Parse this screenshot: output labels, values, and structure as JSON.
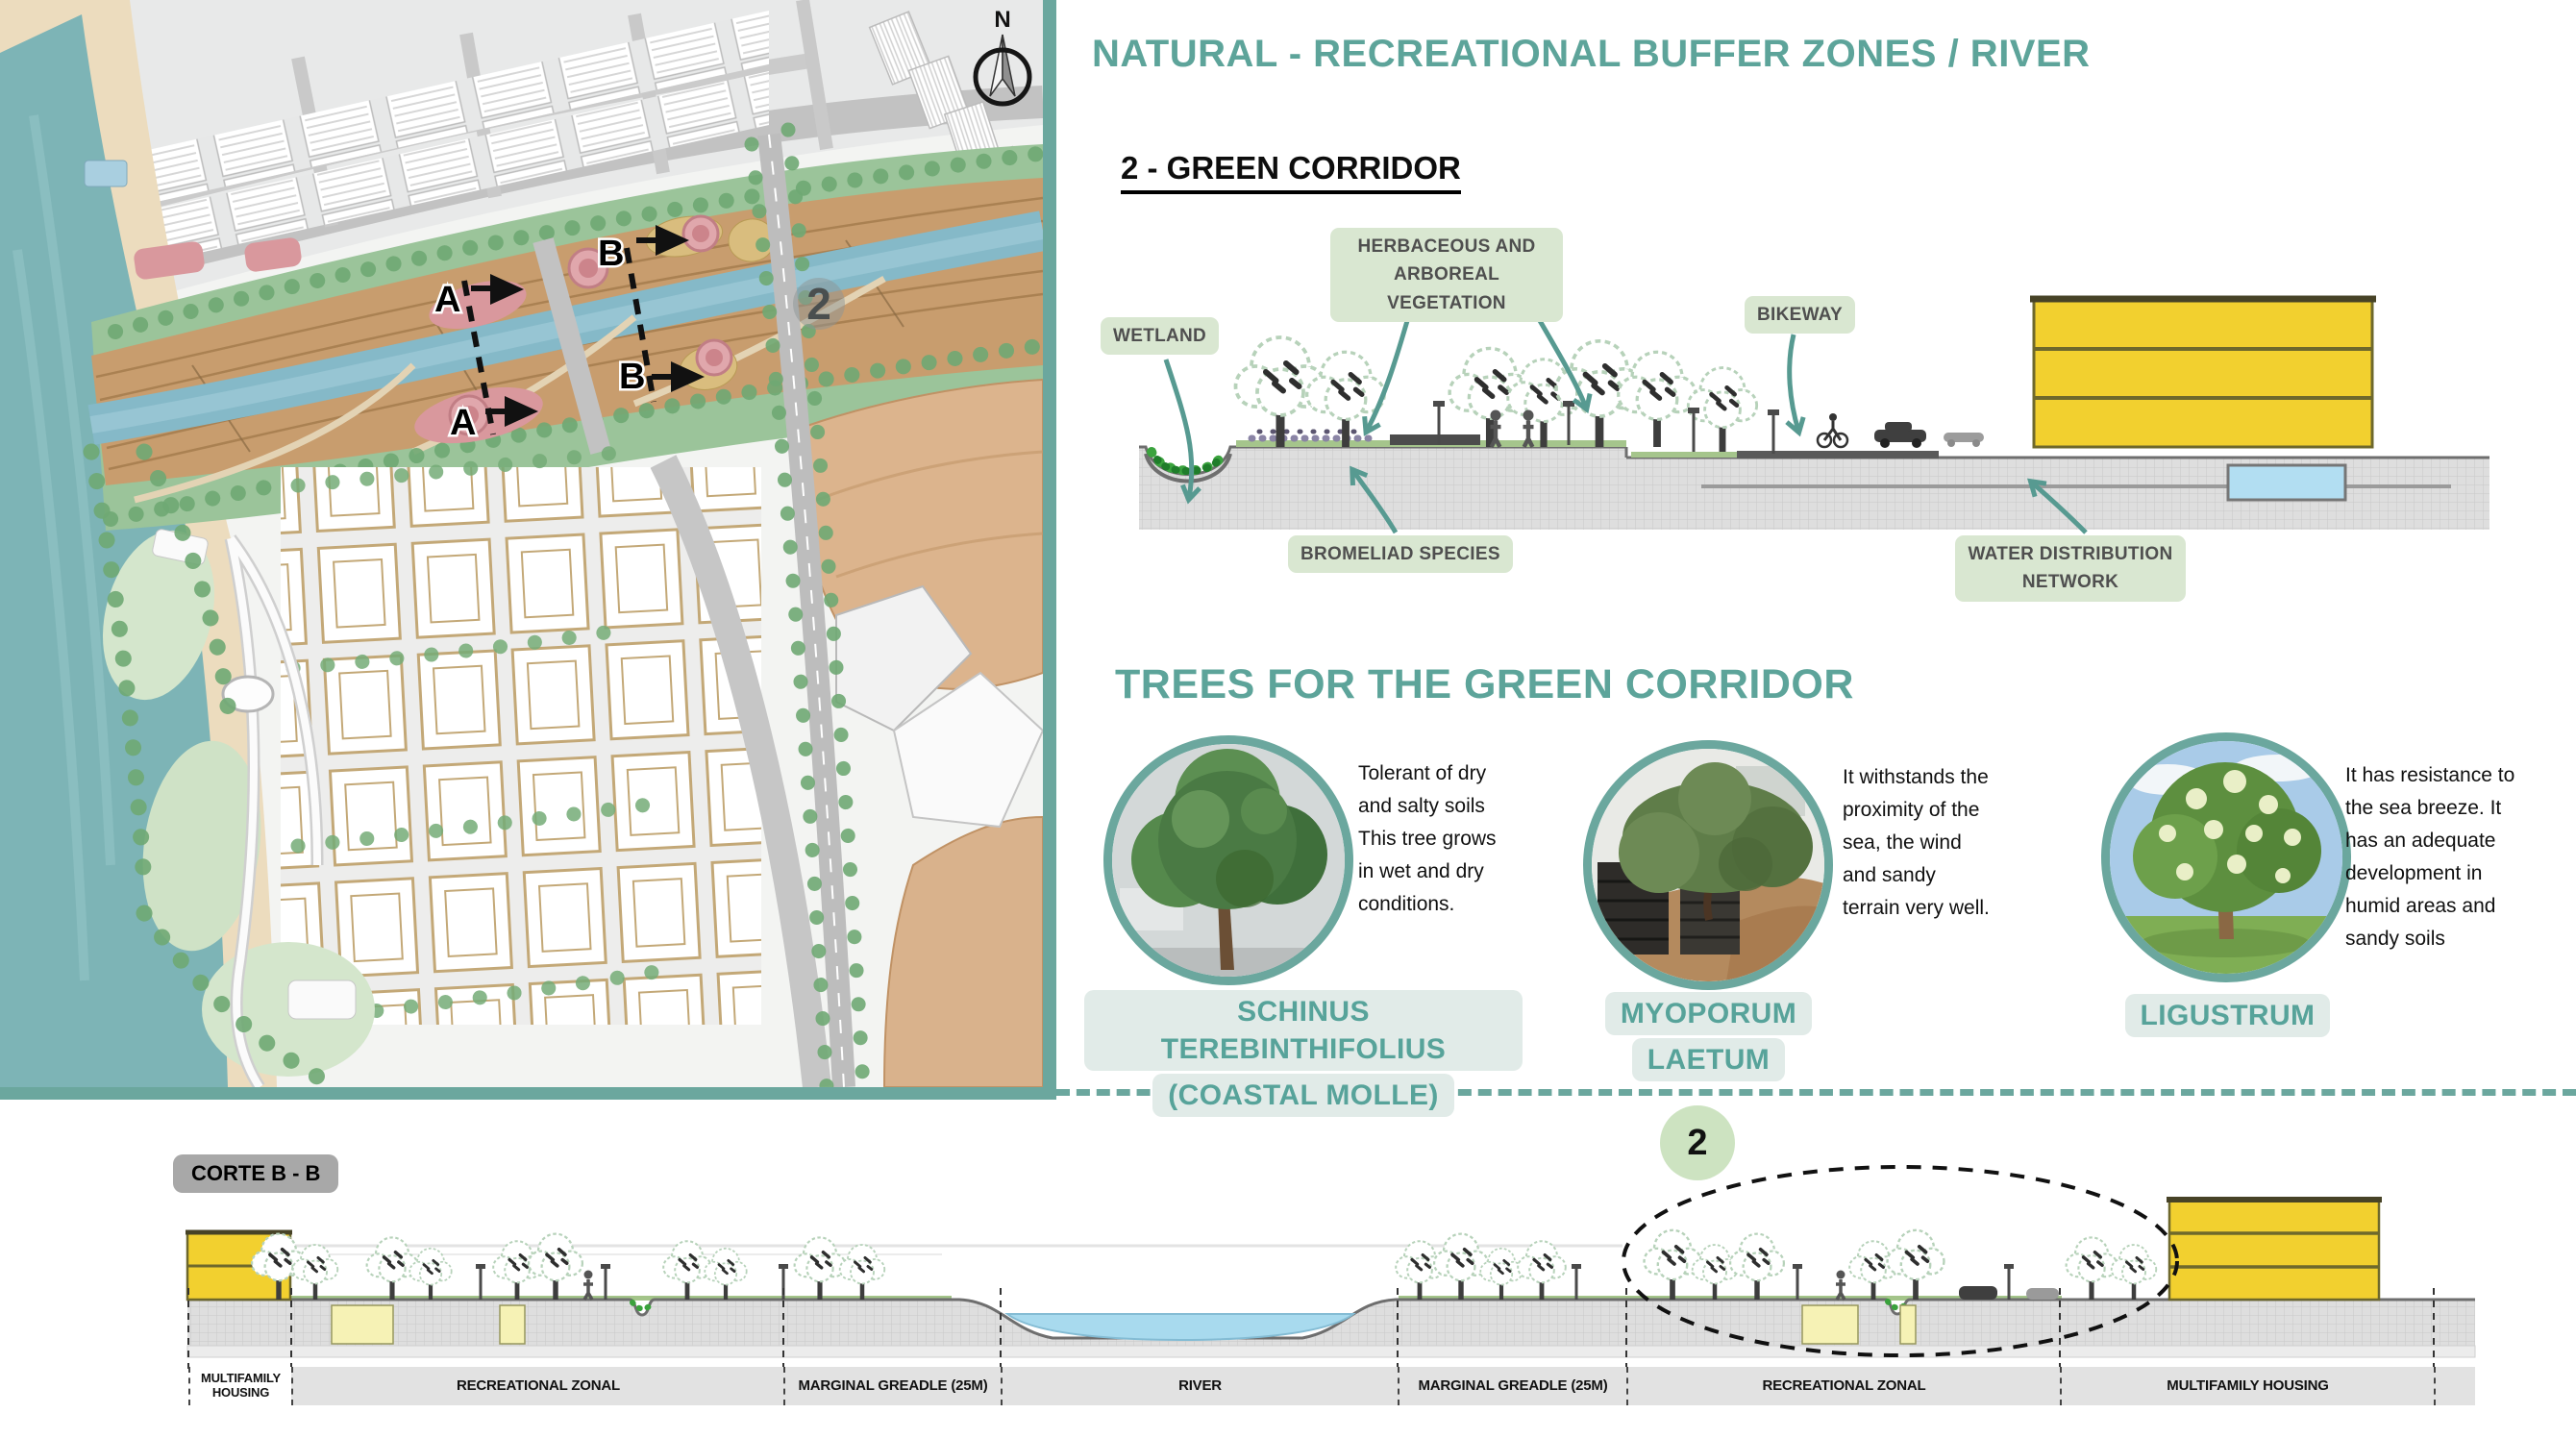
{
  "header": {
    "title": "NATURAL - RECREATIONAL BUFFER ZONES / RIVER"
  },
  "green_corridor": {
    "heading": "2 - GREEN CORRIDOR",
    "labels": {
      "wetland": "WETLAND",
      "herbaceous_line1": "HERBACEOUS AND",
      "herbaceous_line2": "ARBOREAL VEGETATION",
      "bikeway": "BIKEWAY",
      "bromeliad": "BROMELIAD SPECIES",
      "water_line1": "WATER DISTRIBUTION",
      "water_line2": "NETWORK"
    }
  },
  "trees": {
    "heading": "TREES FOR THE GREEN CORRIDOR",
    "items": [
      {
        "name_line1": "SCHINUS TEREBINTHIFOLIUS",
        "name_line2": "(COASTAL MOLLE)",
        "description": "Tolerant of dry and salty soils This tree grows in wet and dry conditions."
      },
      {
        "name_line1": "MYOPORUM",
        "name_line2": "LAETUM",
        "description": "It withstands the proximity of the sea, the wind and sandy terrain very well."
      },
      {
        "name_line1": "LIGUSTRUM",
        "name_line2": "",
        "description": "It has resistance to the sea breeze. It has an adequate development in humid areas and sandy soils"
      }
    ]
  },
  "map": {
    "compass_label": "N",
    "corridor_number": "2",
    "section_a_label": "A",
    "section_b_label": "B"
  },
  "corte": {
    "title": "CORTE B - B",
    "badge": "2",
    "zones": [
      "MULTIFAMILY HOUSING",
      "RECREATIONAL ZONAL",
      "MARGINAL GREADLE (25M)",
      "RIVER",
      "MARGINAL GREADLE (25M)",
      "RECREATIONAL ZONAL",
      "MULTIFAMILY HOUSING"
    ]
  },
  "colors": {
    "accent_teal": "#6ba79e",
    "title_teal": "#5da49a",
    "label_green_bg": "#d9e7d1",
    "building_yellow": "#f2d02f",
    "water_blue": "#a8daee",
    "sea_teal": "#7db4b6"
  }
}
